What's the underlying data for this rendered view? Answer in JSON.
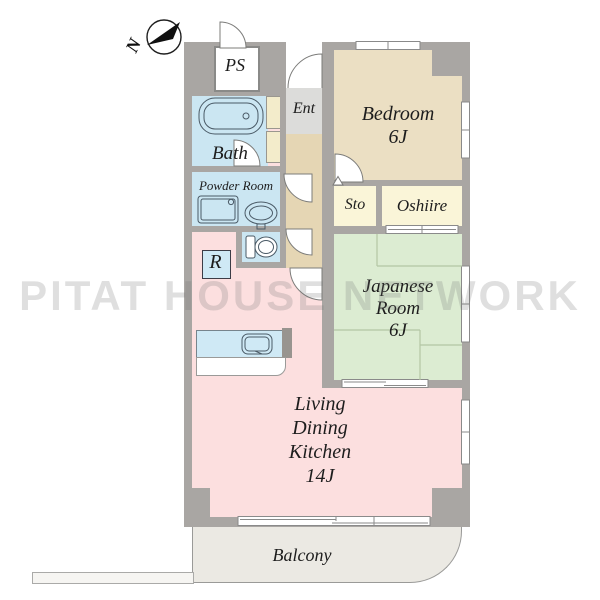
{
  "watermark": "PITAT HOUSE NETWORK",
  "compass": {
    "north_label": "N"
  },
  "rooms": {
    "ps": {
      "label": "PS"
    },
    "bath": {
      "label": "Bath"
    },
    "ent": {
      "label": "Ent"
    },
    "bedroom": {
      "label": "Bedroom",
      "size": "6J"
    },
    "powder_room": {
      "label": "Powder  Room"
    },
    "storage": {
      "label": "Sto"
    },
    "oshiire": {
      "label": "Oshiire"
    },
    "japanese_room": {
      "line1": "Japanese",
      "line2": "Room",
      "size": "6J"
    },
    "refrigerator": {
      "label": "R"
    },
    "ldk": {
      "line1": "Living",
      "line2": "Dining",
      "line3": "Kitchen",
      "size": "14J"
    },
    "balcony": {
      "label": "Balcony"
    }
  },
  "colors": {
    "wall": "#a9a6a3",
    "water_rooms": "#cbe6f2",
    "bedroom": "#ebdfc3",
    "hall": "#e5d6b4",
    "entrance": "#dcdcda",
    "storage_rooms": "#faf5d8",
    "japanese_room": "#dcecd2",
    "ldk": "#fcdfdf",
    "balcony": "#ebe9e3"
  }
}
